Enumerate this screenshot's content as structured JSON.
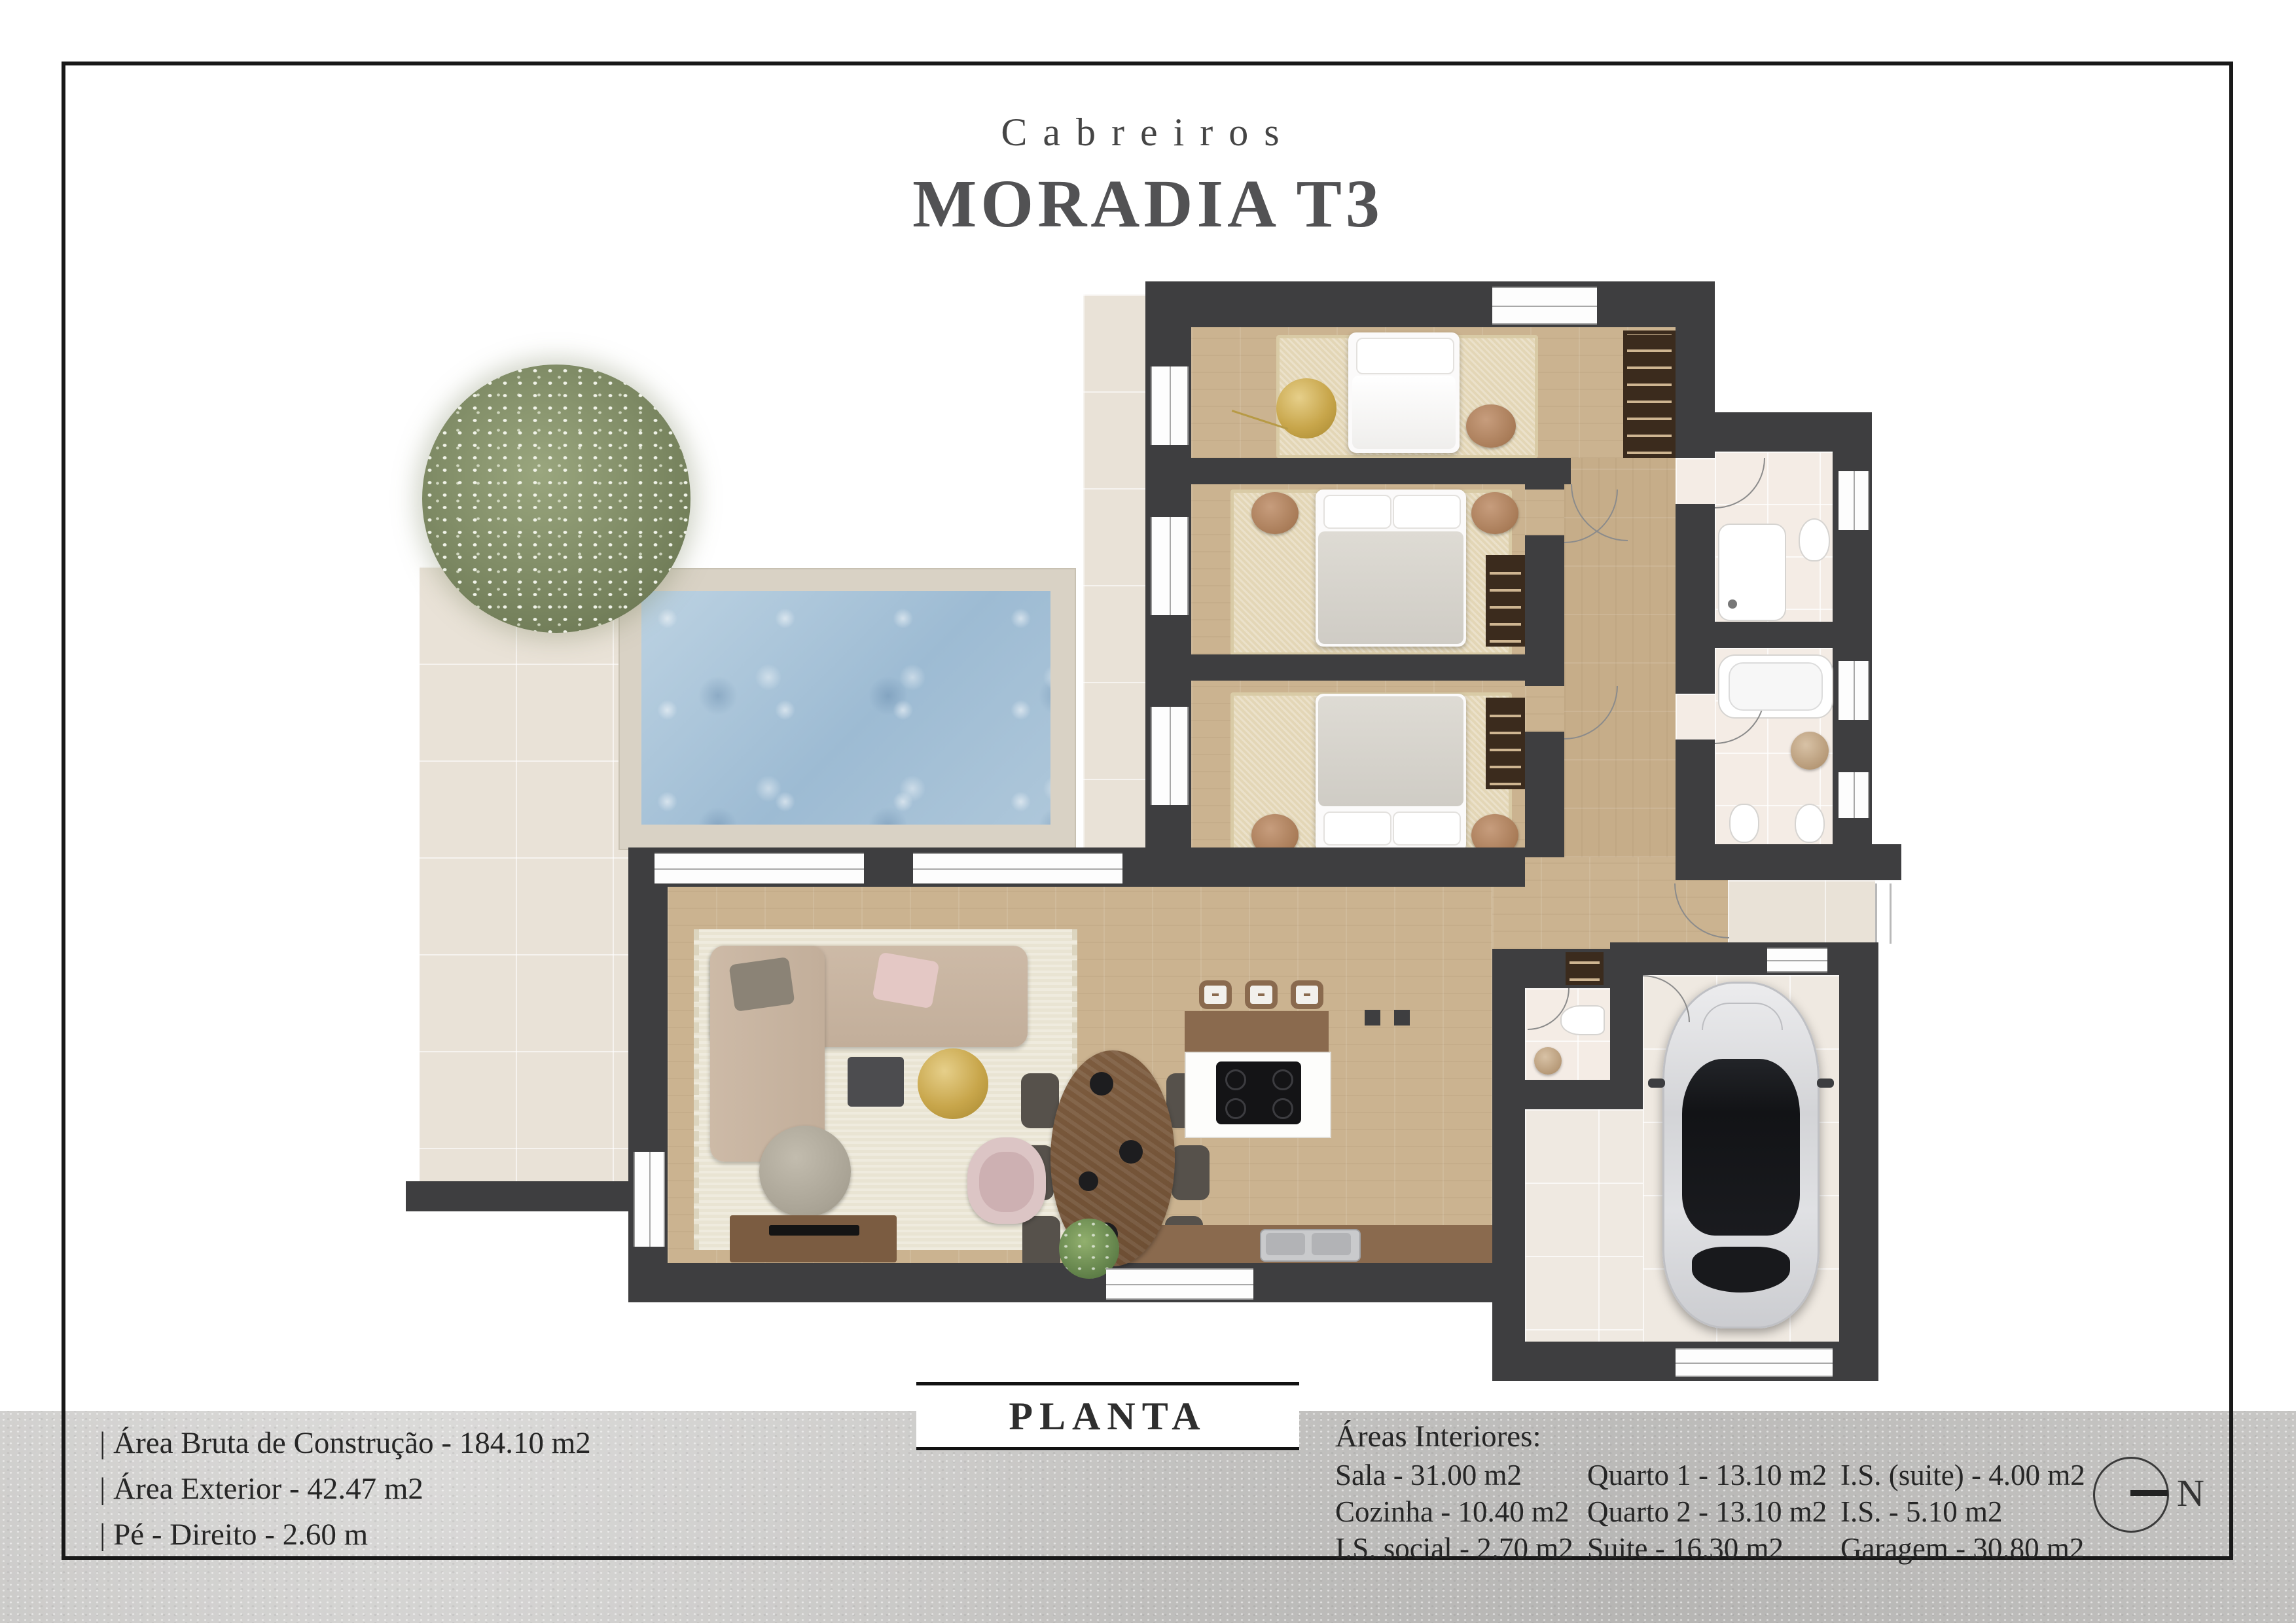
{
  "header": {
    "location": "Cabreiros",
    "title": "MORADIA T3"
  },
  "plan": {
    "label": "PLANTA"
  },
  "compass": {
    "north_label": "N"
  },
  "exterior_info": {
    "lines": [
      "| Área Bruta de Construção - 184.10 m2",
      "| Área Exterior - 42.47 m2",
      "| Pé - Direito - 2.60 m"
    ]
  },
  "interior_areas": {
    "heading": "Áreas Interiores:",
    "columns": [
      [
        "Sala - 31.00 m2",
        "Cozinha - 10.40 m2",
        "I.S. social - 2.70 m2"
      ],
      [
        "Quarto 1 - 13.10 m2",
        "Quarto 2 - 13.10 m2",
        "Suite - 16.30 m2"
      ],
      [
        "I.S. (suite) - 4.00 m2",
        "I.S. - 5.10 m2",
        "Garagem - 30.80 m2"
      ]
    ]
  },
  "colors": {
    "wall": "#3e3e40",
    "wood_floor": "#cbb390",
    "patio_tile": "#e9e2d7",
    "bath_tile": "#f4ece5",
    "pool_water": "#a9c3d8",
    "pool_deck": "#d9d2c5",
    "accent_gold": "#c8a64b",
    "car_silver": "#d7d8da",
    "band_gray": "#c7c6c4"
  }
}
